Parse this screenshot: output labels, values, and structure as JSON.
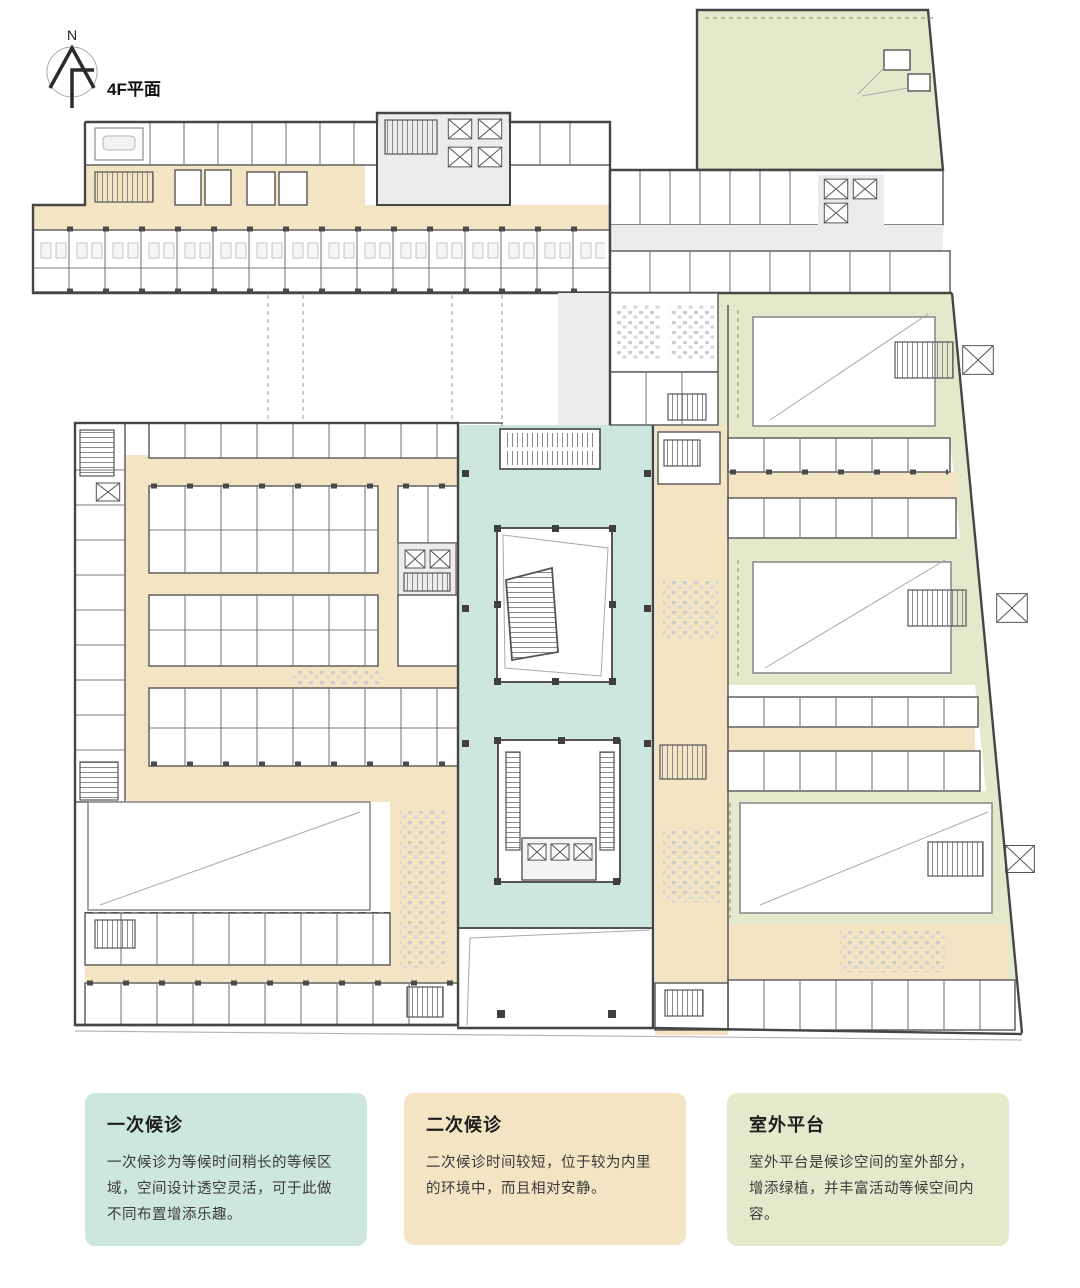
{
  "header": {
    "north_label": "N",
    "plan_title": "4F平面"
  },
  "zones": {
    "primary": {
      "label": "一次候诊",
      "color": "#cde7e0"
    },
    "secondary": {
      "label": "二次候诊",
      "color": "#f3e4c3"
    },
    "outdoor": {
      "label": "室外平台",
      "color": "#e5e9cb"
    }
  },
  "legend": [
    {
      "zone": "primary",
      "title": "一次候诊",
      "description": "一次候诊为等候时间稍长的等候区域，空间设计透空灵活，可于此做不同布置增添乐趣。"
    },
    {
      "zone": "secondary",
      "title": "二次候诊",
      "description": "二次候诊时间较短，位于较为内里的环境中，而且相对安静。"
    },
    {
      "zone": "outdoor",
      "title": "室外平台",
      "description": "室外平台是候诊空间的室外部分，增添绿植，并丰富活动等候空间内容。"
    }
  ]
}
